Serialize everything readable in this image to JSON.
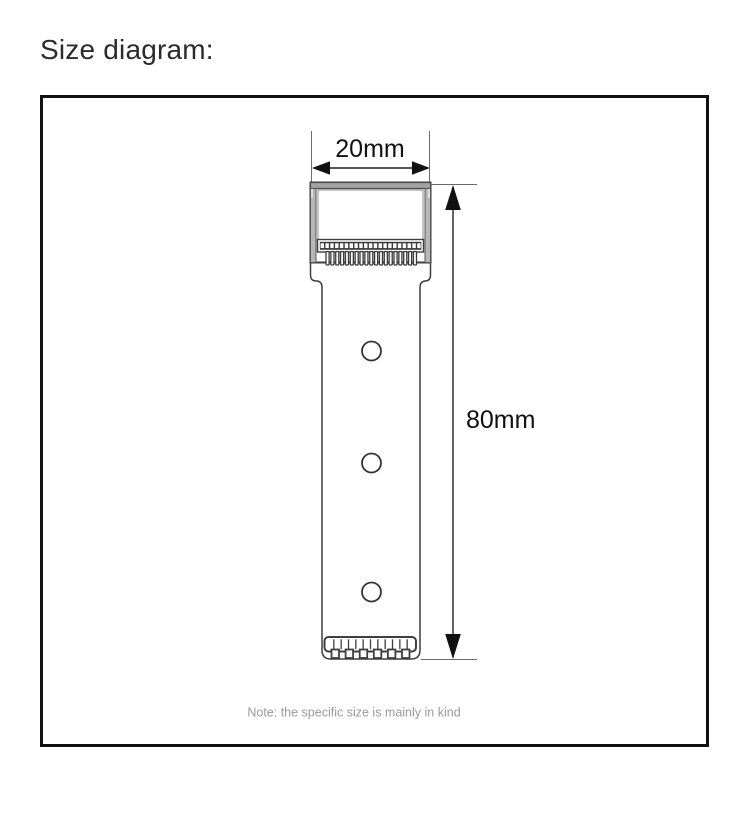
{
  "header": {
    "title": "Size diagram:"
  },
  "diagram": {
    "width_label": "20mm",
    "height_label": "80mm",
    "note": "Note: the specific size is mainly in kind",
    "object": {
      "hole_count": 3,
      "head_slot_count": 21,
      "head_teeth_count": 19,
      "grip_ridge_count": 11,
      "grip_teeth_count": 6
    },
    "colors": {
      "outline": "#3f3f3f",
      "frame_border": "#111111",
      "head_bar_gray": "#a3a3a3",
      "head_wall_gray": "#b7b7b7",
      "strip_dark": "#3a3a3a",
      "note_text": "#999999",
      "title_text": "#2b2b2b"
    }
  }
}
